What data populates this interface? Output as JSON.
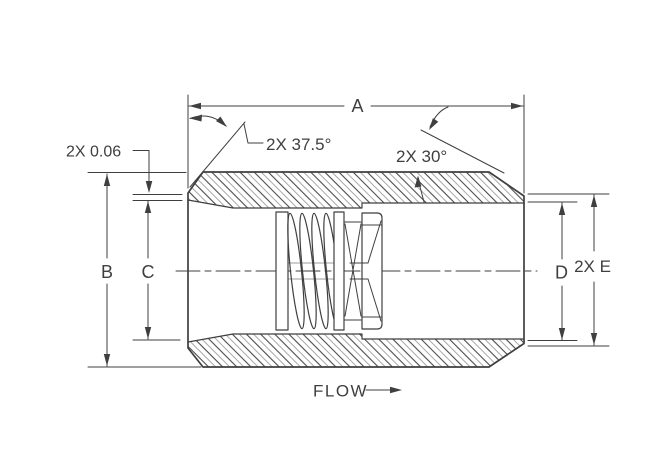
{
  "drawing": {
    "dims": {
      "overall_length": "A",
      "body_diameter": "B",
      "inlet_bore": "C",
      "outlet_bore": "D",
      "end_face": "2X E",
      "face_land": "2X 0.06",
      "chamfer_front": "2X 37.5°",
      "chamfer_rear": "2X 30°"
    },
    "flow_label": "FLOW",
    "colors": {
      "line": "#3f3f3f",
      "hatch_dark": "#4a4a4a",
      "hatch_light": "#9e9e9e",
      "background": "#ffffff"
    }
  }
}
